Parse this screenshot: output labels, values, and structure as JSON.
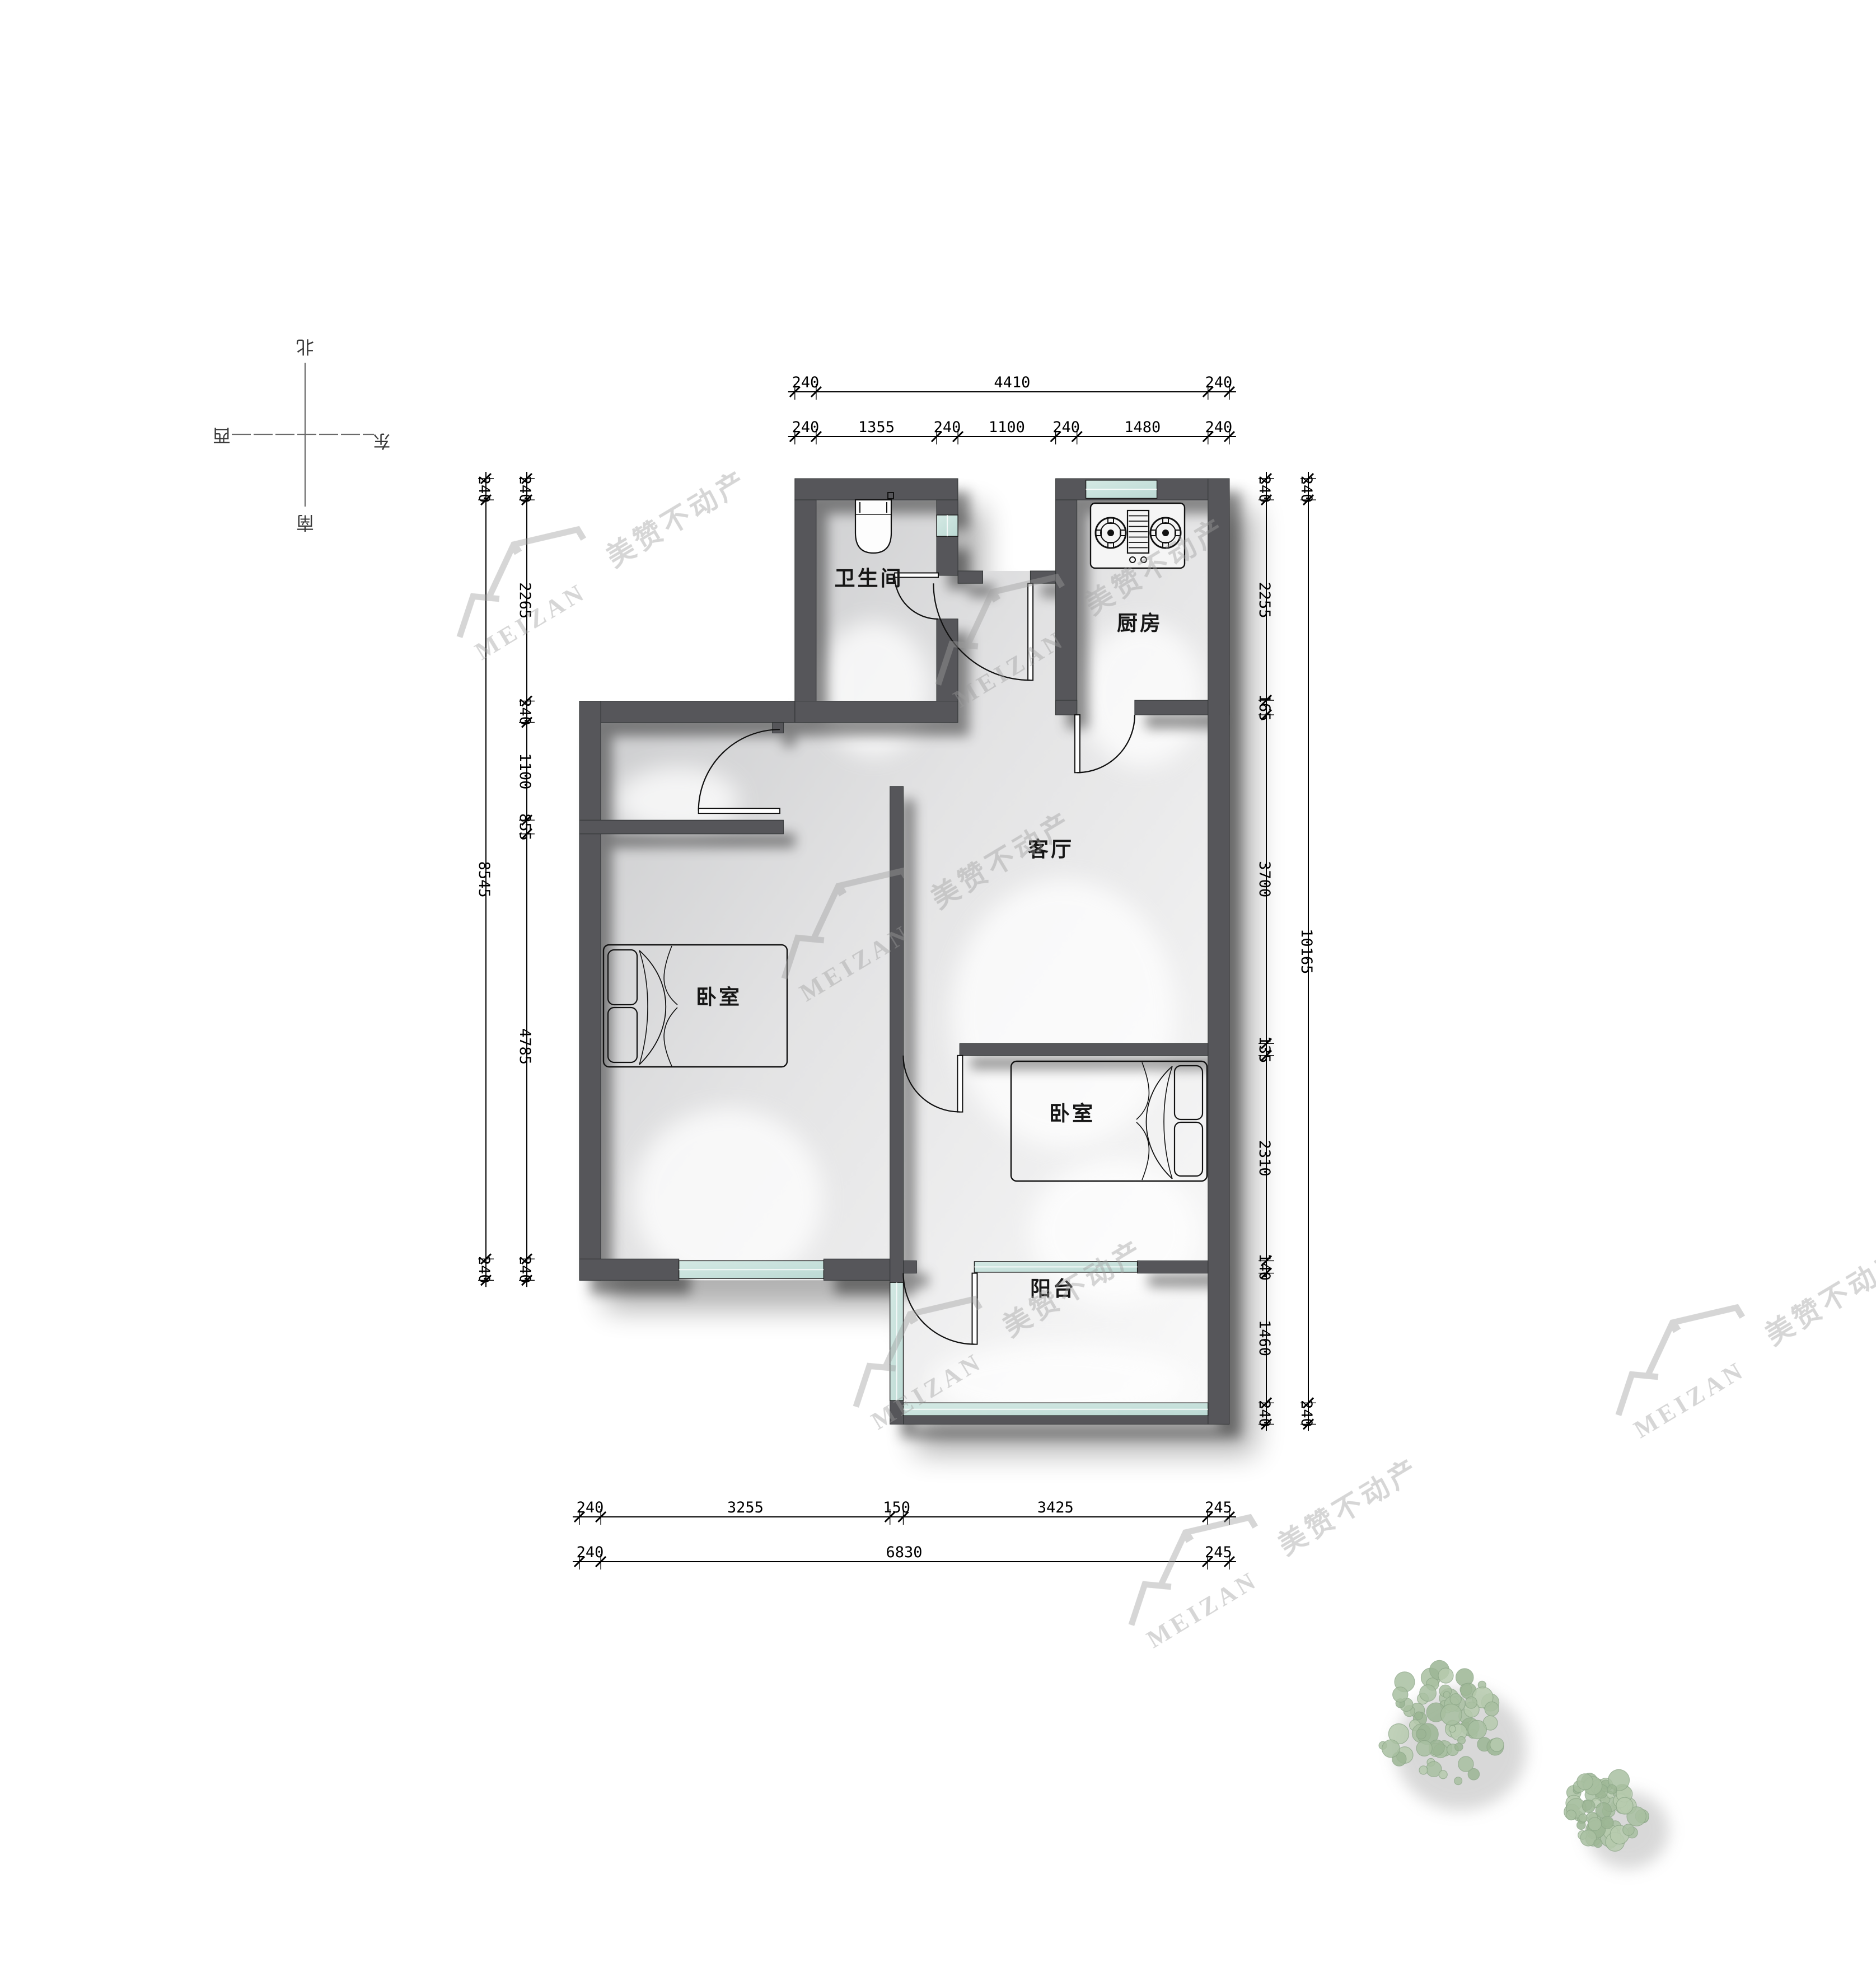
{
  "plan": {
    "rooms": [
      {
        "id": "bathroom",
        "label": "卫生间"
      },
      {
        "id": "kitchen",
        "label": "厨房"
      },
      {
        "id": "living-room",
        "label": "客厅"
      },
      {
        "id": "bedroom-left",
        "label": "卧室"
      },
      {
        "id": "bedroom-right",
        "label": "卧室"
      },
      {
        "id": "balcony",
        "label": "阳台"
      }
    ],
    "fixtures": [
      {
        "id": "toilet"
      },
      {
        "id": "gas-stove"
      },
      {
        "id": "bed-left"
      },
      {
        "id": "bed-right"
      }
    ]
  },
  "dimensions": {
    "top_outer": [
      "240",
      "4410",
      "240"
    ],
    "top_inner": [
      "240",
      "1355",
      "240",
      "1100",
      "240",
      "1480",
      "240"
    ],
    "left_outer": [
      "240",
      "8545",
      "240"
    ],
    "left_inner": [
      "240",
      "2265",
      "240",
      "1100",
      "855",
      "4785",
      "240"
    ],
    "right_inner": [
      "240",
      "2255",
      "165",
      "3700",
      "135",
      "2310",
      "140",
      "1460",
      "240"
    ],
    "right_outer": [
      "240",
      "10165",
      "240"
    ],
    "bottom_inner": [
      "240",
      "3255",
      "150",
      "3425",
      "245"
    ],
    "bottom_outer": [
      "240",
      "6830",
      "245"
    ]
  },
  "compass": {
    "north": "北",
    "south": "南",
    "east": "东",
    "west": "西"
  },
  "watermark": {
    "brand_latin": "MEIZAN",
    "brand_cn": "美赞不动产"
  },
  "colors": {
    "wall": "#56575a",
    "wall_edge": "#2f3032",
    "window_glass": "#d4e9e4",
    "window_glass2": "#bcdad4",
    "window_frame": "#1c1c1c",
    "line": "#111111",
    "watermark": "#9e9e9e",
    "tree_fill": "#a9c0a1",
    "tree_fill2": "#b7cbae",
    "tree_stroke": "#8fa98a"
  }
}
